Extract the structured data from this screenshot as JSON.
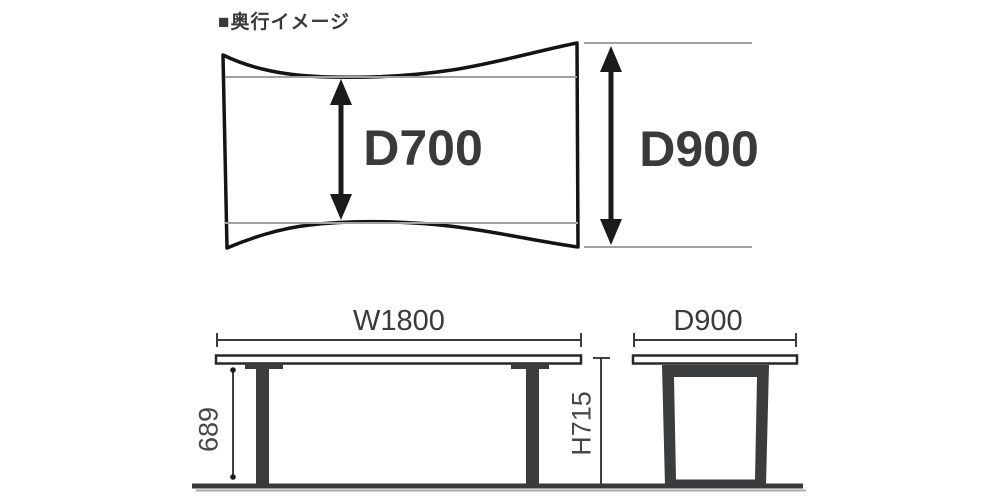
{
  "title": {
    "label": "■奥行イメージ"
  },
  "top_view": {
    "name": "tabletop-depth-plan-view",
    "depth_min_label": "D700",
    "depth_max_label": "D900"
  },
  "front_view": {
    "name": "table-front-elevation",
    "width_label": "W1800",
    "leg_height_label": "689"
  },
  "side_view": {
    "name": "table-side-elevation",
    "depth_label": "D900",
    "height_label": "H715"
  },
  "colors": {
    "outline_black": "#141414",
    "dark_gray_fill": "#3b3c3e",
    "dimension_text": "#3a3a3c",
    "guide_line_gray": "#a0a0a0",
    "background": "#ffffff"
  }
}
